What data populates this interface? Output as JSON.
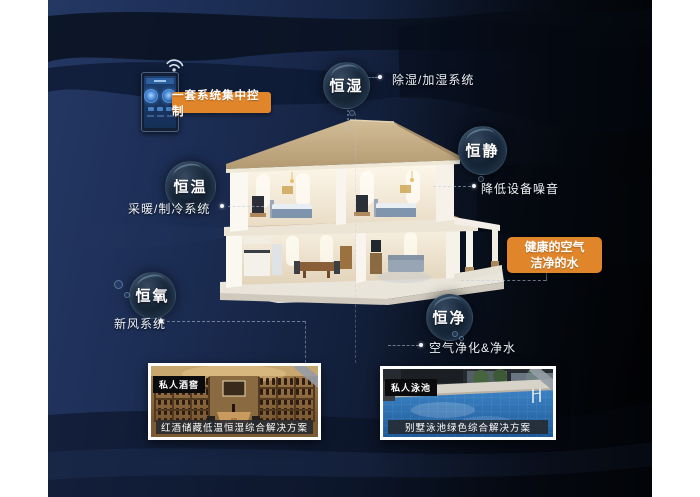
{
  "poster": {
    "control_panel": {
      "label": "一套系统集中控制"
    },
    "bubbles": [
      {
        "label": "恒湿",
        "note": "除湿/加湿系统"
      },
      {
        "label": "恒静",
        "note": "降低设备噪音"
      },
      {
        "label": "恒温",
        "note": "采暖/制冷系统"
      },
      {
        "label": "恒氧",
        "note": "新风系统"
      },
      {
        "label": "恒净",
        "note": "空气净化&净水"
      }
    ],
    "highlight": {
      "line1": "健康的空气",
      "line2": "洁净的水"
    },
    "cards": [
      {
        "tag": "私人酒窖",
        "caption": "红酒储藏低温恒湿综合解决方案"
      },
      {
        "tag": "私人泳池",
        "caption": "别墅泳池绿色综合解决方案"
      }
    ],
    "colors": {
      "accent_orange": "#e0852a",
      "background_navy": "#1d2f58",
      "background_black": "#04070d",
      "bubble_text": "#ffffff"
    },
    "icons": {
      "wifi": "wifi-icon",
      "panel": "smart-control-panel"
    }
  }
}
